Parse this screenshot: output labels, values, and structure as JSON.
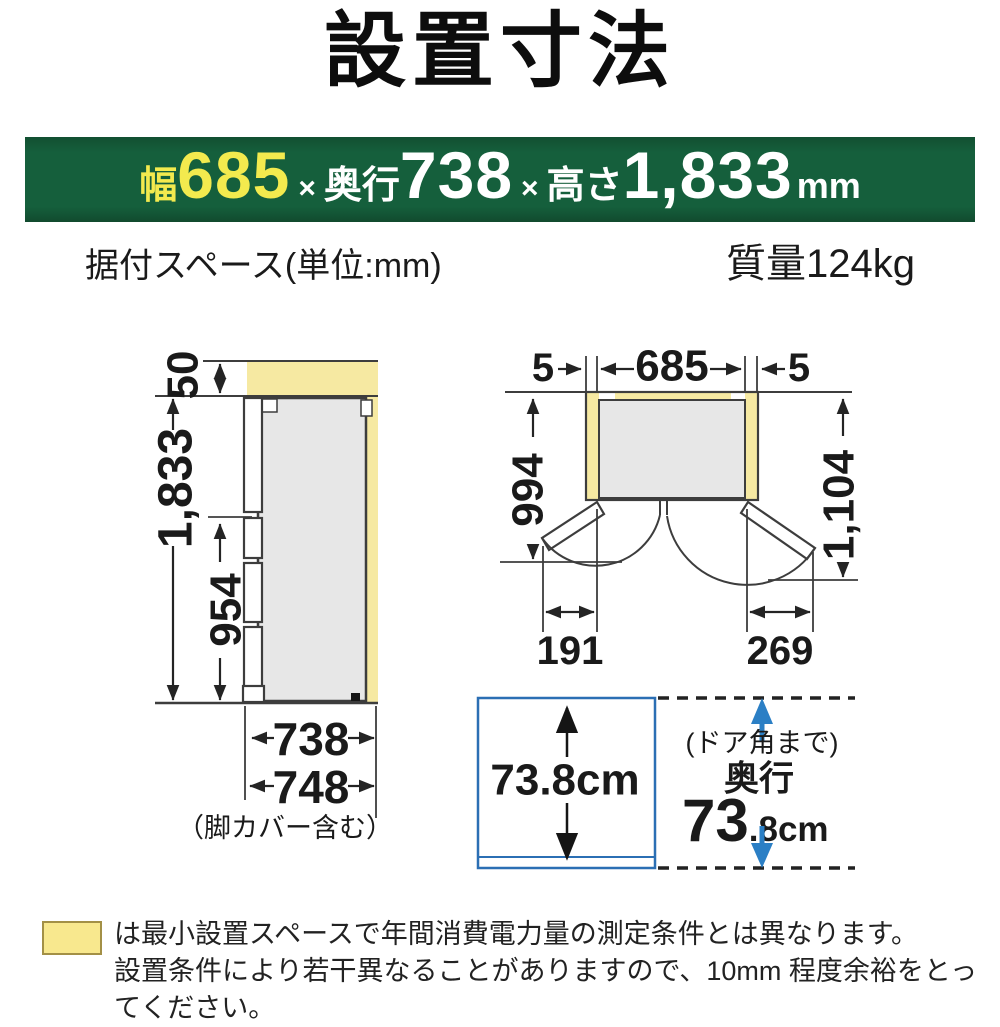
{
  "page": {
    "title": "設置寸法"
  },
  "banner": {
    "width_label": "幅",
    "width_value": "685",
    "times1": "×",
    "depth_label": "奥行",
    "depth_value": "738",
    "times2": "×",
    "height_label": "高さ",
    "height_value": "1,833",
    "unit": "mm",
    "bg_color": "#155f3c",
    "accent_text_color": "#f3ea4e"
  },
  "subheader": {
    "left": "据付スペース(単位:mm)",
    "right": "質量124kg"
  },
  "side_view": {
    "top_clearance": "50",
    "total_height": "1,833",
    "lower_section_height": "954",
    "depth": "738",
    "depth_with_leg_cover": "748",
    "leg_cover_note": "（脚カバー含む）"
  },
  "top_view": {
    "left_clearance": "5",
    "width": "685",
    "right_clearance": "5",
    "depth_left_door_open": "994",
    "depth_right_door_open": "1,104",
    "left_door_projection": "191",
    "right_door_projection": "269"
  },
  "depth_view": {
    "box_depth": "73.8cm",
    "door_corner_note": "(ドア角まで)",
    "depth_word": "奥行",
    "depth_big": "73",
    "depth_small": ".8cm",
    "accent_color": "#2b7fc5"
  },
  "footnote": {
    "line1": "は最小設置スペースで年間消費電力量の測定条件とは異なります。",
    "line2": "設置条件により若干異なることがありますので、10mm 程度余裕をとってください。",
    "swatch_color": "#f8e88e",
    "clearance_fill_color": "#f6e9a2"
  }
}
